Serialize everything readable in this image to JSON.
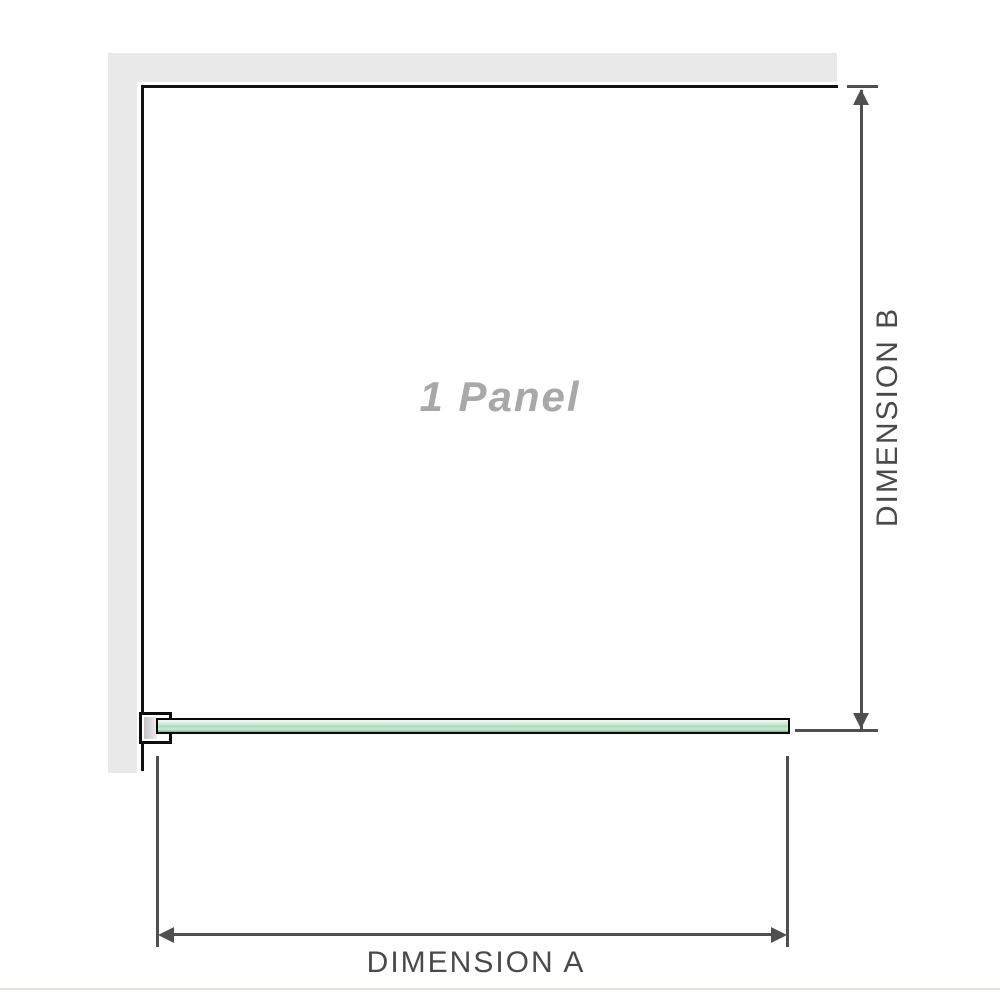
{
  "diagram": {
    "panel_label": "1 Panel",
    "dimensions": {
      "a_label": "DIMENSION A",
      "b_label": "DIMENSION B"
    },
    "colors": {
      "wall_gray": "#e9e9e9",
      "outline_black": "#111111",
      "dimension_gray": "#4f4f4f",
      "dimension_text_gray": "#4a4a4a",
      "panel_label_gray": "#a8a8a8",
      "glass_green_light": "#f3faf5",
      "glass_green_mid": "#a8dbb6",
      "glass_green_dark": "#7cc091",
      "bracket_metal_gray": "#c3c3c3",
      "baseline_gray": "#e1e4da"
    }
  }
}
